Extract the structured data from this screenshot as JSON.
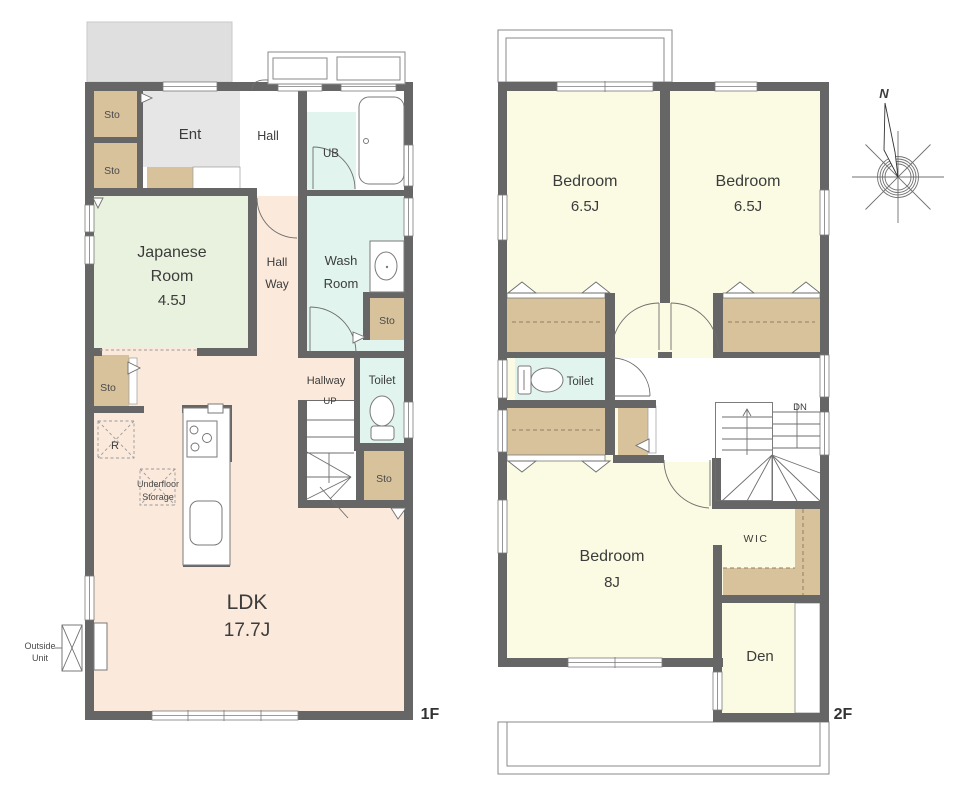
{
  "colors": {
    "wall": "#666666",
    "floor": "#FBE9DB",
    "tatami": "#E9F2DE",
    "wet": "#E1F4ED",
    "storage": "#D8C29C",
    "bedroom": "#FBFBE3",
    "entrance": "#E6E6E6",
    "porch": "#DFDFDF"
  },
  "floor1": {
    "label": "1F",
    "sto": "Sto",
    "ent": "Ent",
    "hall": "Hall",
    "ub": "UB",
    "japanese_room": {
      "l1": "Japanese",
      "l2": "Room",
      "size": "4.5J"
    },
    "hallway_upper": {
      "l1": "Hall",
      "l2": "Way"
    },
    "wash_room": {
      "l1": "Wash",
      "l2": "Room"
    },
    "hallway_lower": "Hallway",
    "up": "UP",
    "toilet": "Toilet",
    "fridge": "R",
    "underfloor": {
      "l1": "Underfloor",
      "l2": "Storage"
    },
    "ldk": {
      "name": "LDK",
      "size": "17.7J"
    },
    "outside_unit": {
      "l1": "Outside",
      "l2": "Unit"
    }
  },
  "floor2": {
    "label": "2F",
    "bedrooms": [
      {
        "name": "Bedroom",
        "size": "6.5J"
      },
      {
        "name": "Bedroom",
        "size": "6.5J"
      },
      {
        "name": "Bedroom",
        "size": "8J"
      }
    ],
    "toilet": "Toilet",
    "dn": "DN",
    "wic": "WIC",
    "den": "Den"
  },
  "compass": {
    "north": "N"
  }
}
